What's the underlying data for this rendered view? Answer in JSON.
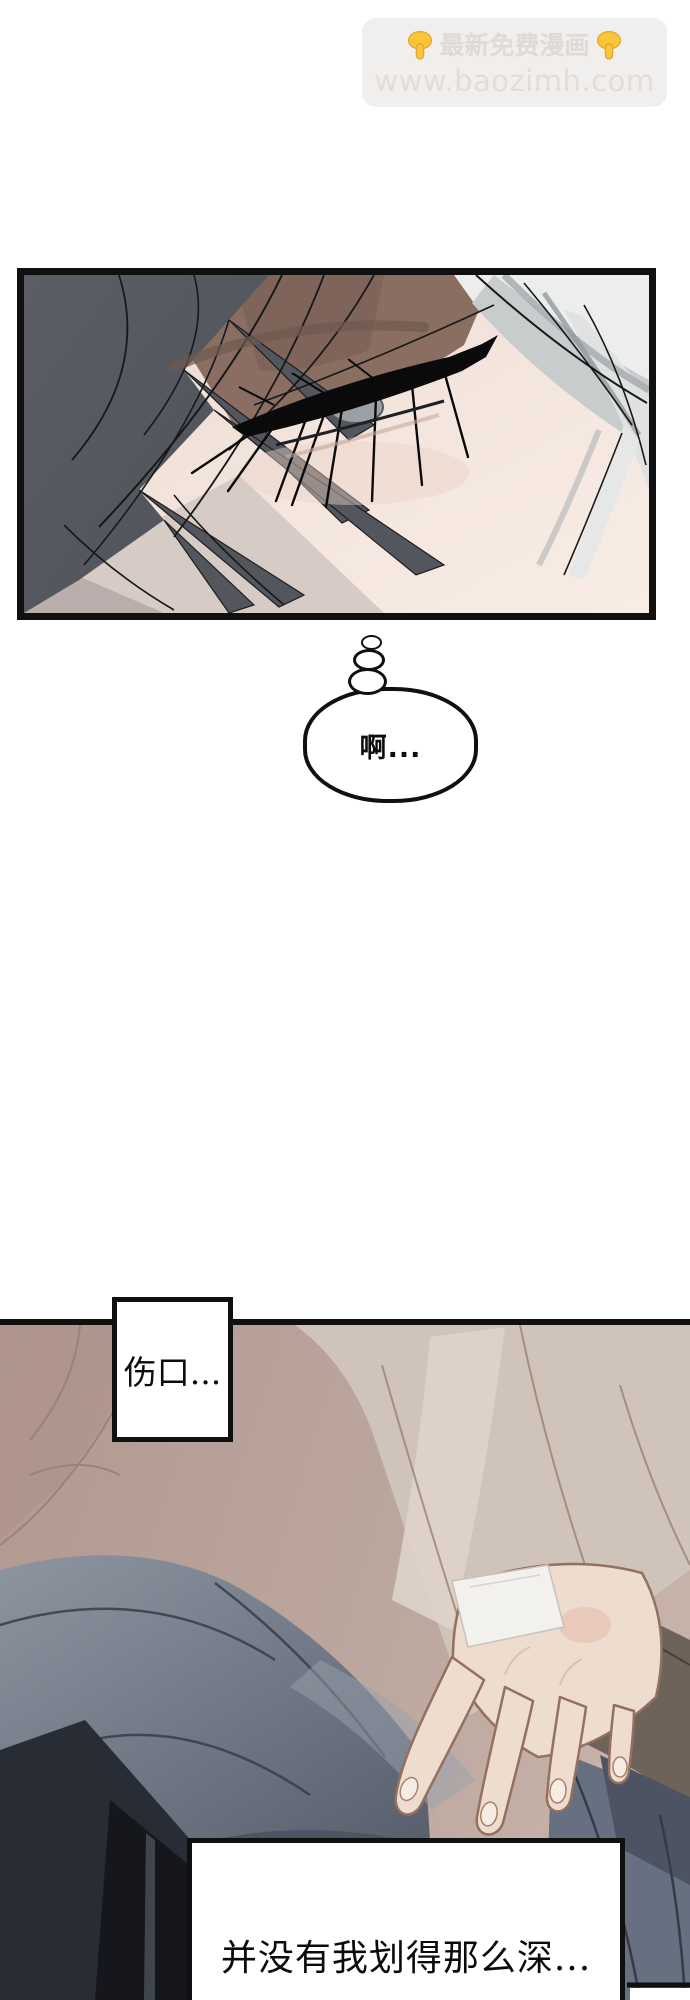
{
  "page": {
    "width_px": 690,
    "height_px": 2000,
    "background": "#ffffff"
  },
  "watermark": {
    "line1": "最新免费漫画",
    "line2": "www.baozimh.com",
    "icons": [
      "point-down-icon",
      "point-down-icon"
    ],
    "box_color": "#f1efee",
    "text_color": "#dedad8",
    "hand_color": "#f9c637"
  },
  "thought_bubble": {
    "text": "啊..."
  },
  "caption1": {
    "text": "伤口..."
  },
  "caption2": {
    "text": "并没有我划得那么深..."
  },
  "panels": [
    {
      "id": "panel-face-closeup",
      "description": "close-up of a face with gray and white hair, closed eye with heavy lashes"
    },
    {
      "id": "panel-hand-on-knee",
      "description": "pale hand with bandage resting on gray-blue fabric, beige sleeve background"
    }
  ],
  "palette": {
    "panel_border": "#101010",
    "skin_light": "#f4e7df",
    "dark_hair": "#54575d",
    "white_hair": "#edefee",
    "forehead_shadow": "#8a6e61",
    "mauve_background": "#b59c94",
    "sleeve_light": "#d0c3b9",
    "cloth_blue_gray": "#6f7886",
    "cloth_dark": "#262a32",
    "hand_skin": "#eedccf",
    "bandage_white": "#f2f1ee"
  }
}
